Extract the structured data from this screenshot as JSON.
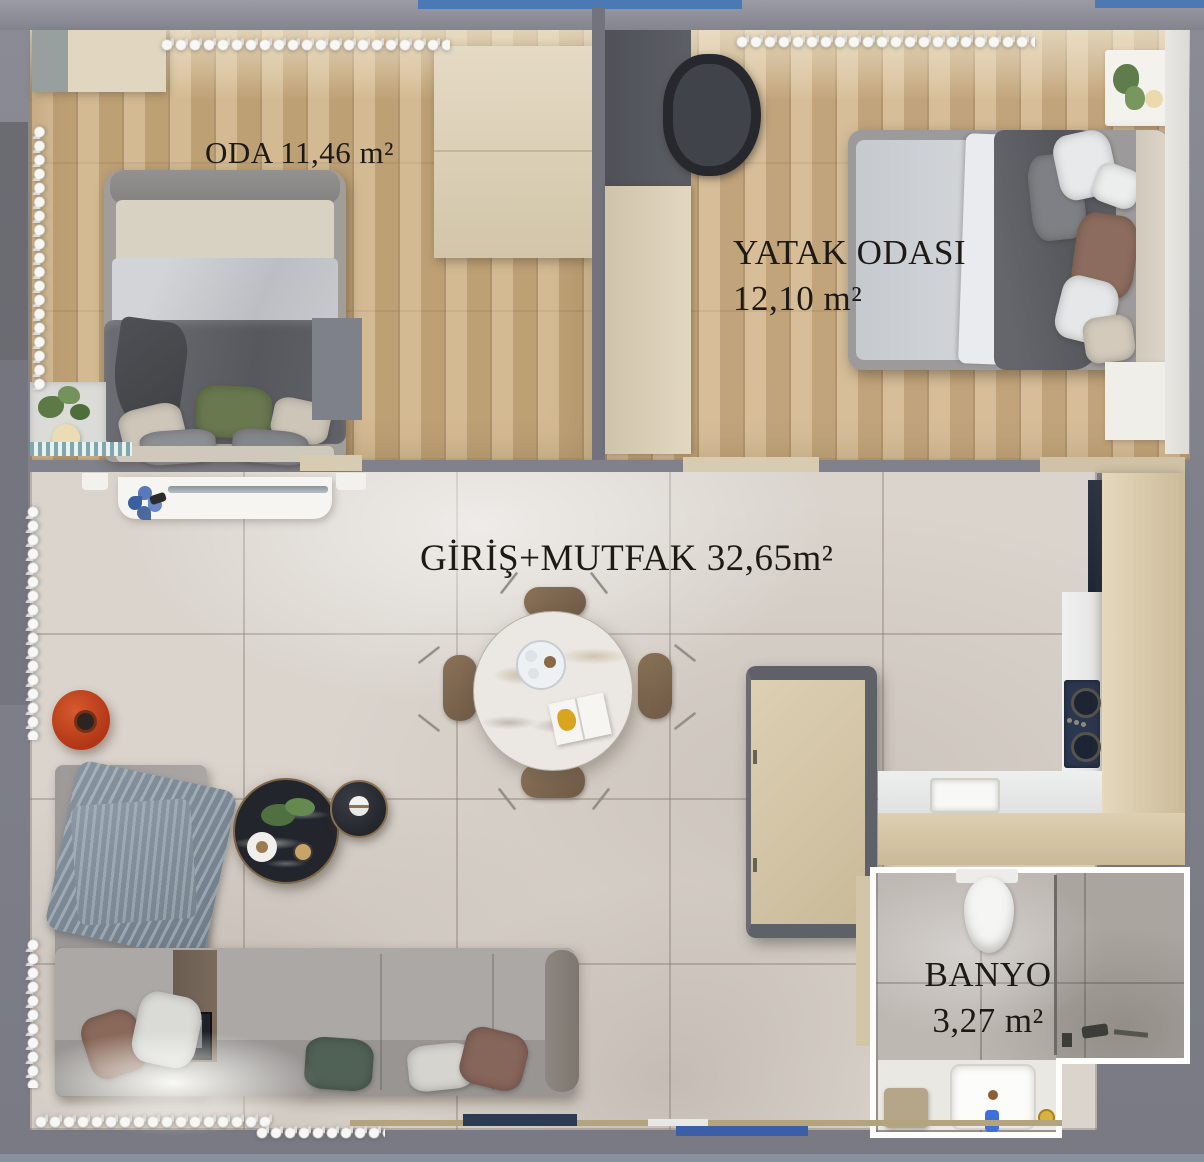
{
  "plan_type": "apartment floor plan (top-down render)",
  "rooms": {
    "oda": {
      "label": "ODA 11,46 m²"
    },
    "yatak": {
      "name": "YATAK ODASI",
      "area": "12,10 m²"
    },
    "giris": {
      "label": "GİRİŞ+MUTFAK 32,65m²"
    },
    "banyo": {
      "name": "BANYO",
      "area": "3,27 m²"
    }
  },
  "colors": {
    "wall_gray": "#7f808a",
    "wall_dark_panel": "#6b6c72",
    "wood_floor": "#c9ab7f",
    "tile_floor": "#dad4cd",
    "bath_tile": "#beb8b3",
    "cabinet_beige": "#ddd1b8",
    "counter_beige": "#d8c9ab",
    "island_frame_gray": "#5f6168",
    "sofa_gray": "#a7a4a2",
    "blanket_blue_gray": "#7c8a97",
    "duvet_dark_gray": "#5e6065",
    "pillow_green": "#69784f",
    "pillow_teal": "#506156",
    "pillow_brown": "#8c6c5e",
    "side_table_red": "#c24420",
    "coffee_table_black": "#22252b",
    "dining_chair_brown": "#7c6551",
    "cooktop_navy": "#2b3750",
    "accent_blue_strip": "#4a79b4",
    "faucet_blue": "#3f6fd8",
    "label_text": "#1d1a16"
  }
}
